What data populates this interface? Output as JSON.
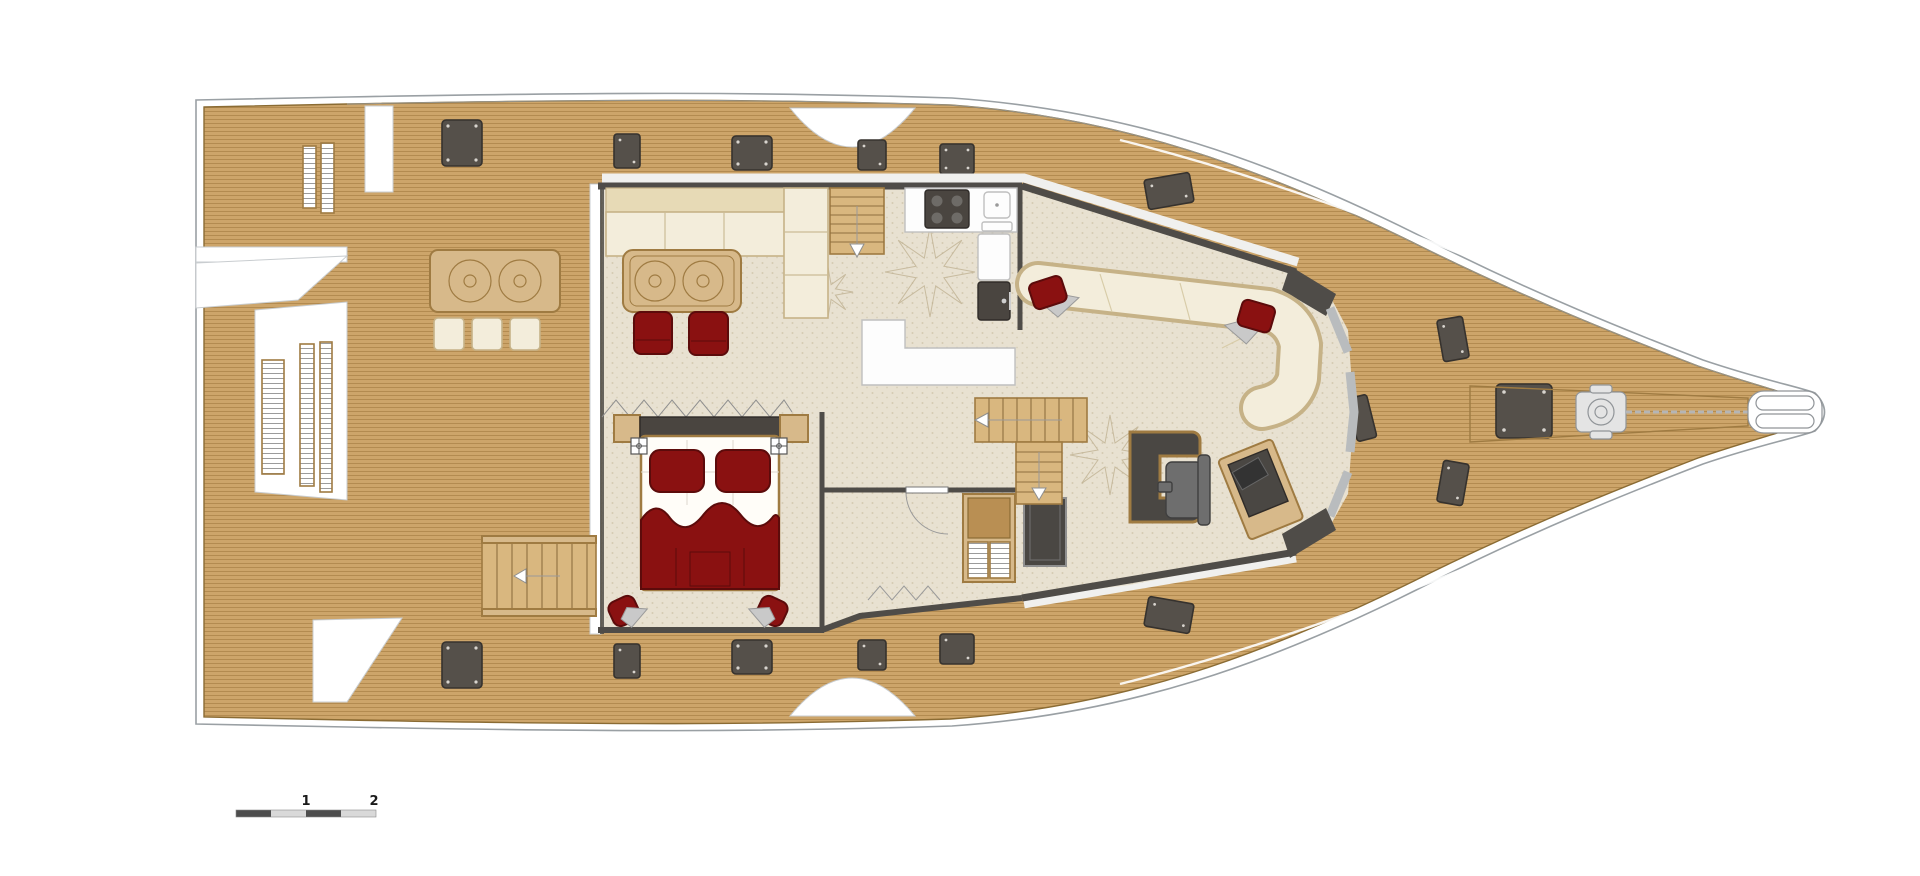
{
  "document": {
    "kind": "yacht-deck-floor-plan",
    "visible_text": [
      "1",
      "2"
    ]
  },
  "scale_bar": {
    "label_mid": "1",
    "label_end": "2",
    "segments": 4
  },
  "colors": {
    "page_bg": "#FFFFFF",
    "hull_line": "#9AA0A4",
    "teak": "#CDA56A",
    "teak_line": "#8C6428",
    "teak_edge": "#8A6B33",
    "floor": "#E8E1D1",
    "floor_speck": "#BFB192",
    "wall": "#4F4C48",
    "window": "#B9BCBE",
    "cream": "#F3EDDB",
    "cream_back": "#E7DAB6",
    "cream_edge": "#C6B287",
    "wood": "#D7B98A",
    "wood_edge": "#9F7B42",
    "red": "#8A1111",
    "red_edge": "#5C0B0B",
    "counter": "#FDFDFD",
    "counter_edge": "#BFBFBF",
    "appliance": "#4A4540",
    "hatch": "#55504A",
    "hatch_edge": "#36322E",
    "hatch_dot": "#D8D4CE",
    "seat_gray": "#6E6E6E",
    "throw_gray": "#C9C9C9",
    "stair_wood": "#D9B77F",
    "stair_line": "#8F6F3F",
    "scale_dark": "#4D4D4D",
    "scale_light": "#D9D9D9",
    "label": "#1A1A1A"
  },
  "parts": [
    "hull",
    "aft-swim-platforms",
    "aft-deck",
    "wet-bar",
    "bar-stools",
    "aft-deck-stairs",
    "deck-hatches",
    "salon",
    "salon-sofa",
    "coffee-table",
    "lounge-chairs",
    "stairs-to-flybridge",
    "galley",
    "cooktop",
    "sink",
    "refrigerator",
    "galley-island",
    "folding-partition",
    "tv-sideboard",
    "owners-cabin",
    "double-bed",
    "reading-lights",
    "bedside-poufs",
    "cabin-door",
    "wardrobe-louvre",
    "shower-panel",
    "stairs-to-hulls",
    "cockpit",
    "cockpit-bench",
    "bench-pillows",
    "helm-console",
    "helm-seat",
    "nav-side-console",
    "foredeck",
    "anchor-locker",
    "windlass",
    "anchor-chain",
    "bowsprit-pads",
    "scale-bar"
  ]
}
